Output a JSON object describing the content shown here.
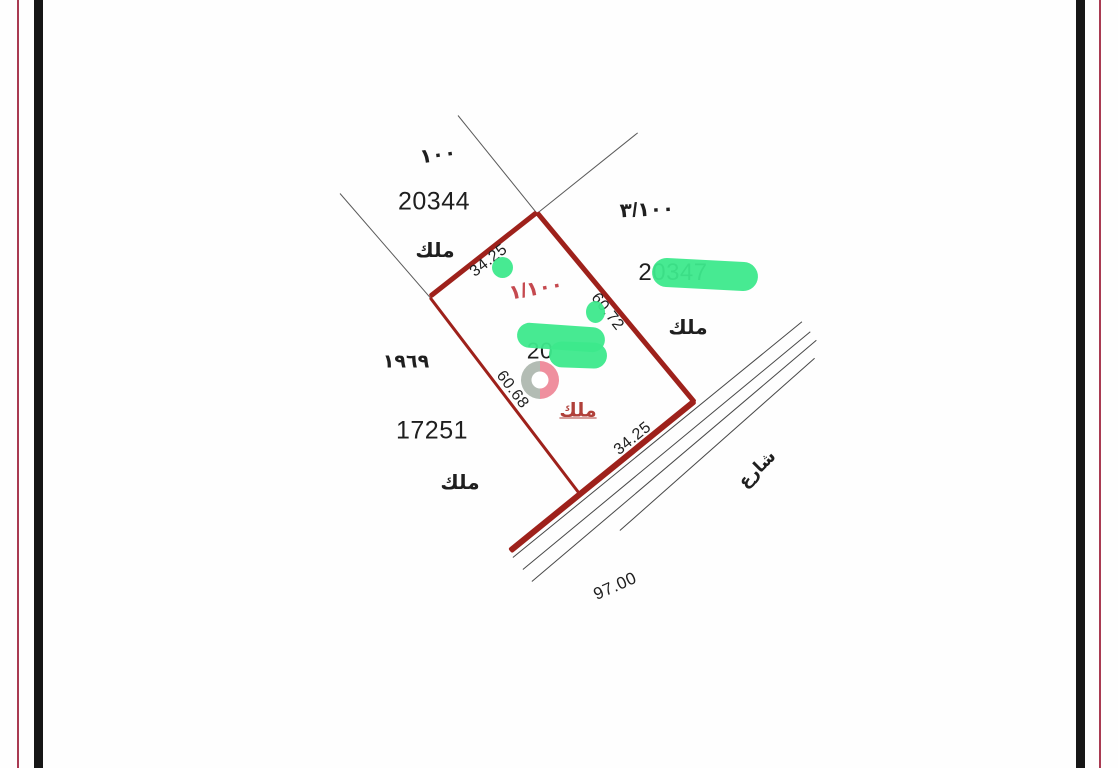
{
  "parcel": {
    "plan_ref": "١/١٠٠",
    "number_visible": "20",
    "tenure": "ملك",
    "dim_top": "34.25",
    "dim_right": "60.72",
    "dim_bottom": "34.25",
    "dim_left": "60.68"
  },
  "neighbors": {
    "north": {
      "ref": "١٠٠",
      "number": "20344",
      "tenure": "ملك"
    },
    "east": {
      "ref": "٣/١٠٠",
      "number": "20347",
      "tenure": "ملك"
    },
    "west": {
      "ref": "١٩٦٩",
      "number": "17251",
      "tenure": "ملك"
    }
  },
  "road": {
    "name": "شارع",
    "frontage": "97.00"
  },
  "colors": {
    "parcel_line": "#9e211b",
    "survey_line": "#5a5a5a",
    "road_line": "#474747",
    "highlight_green": "#3de98c",
    "marker_gray": "#b3bcb4",
    "marker_pink": "#ef8f9e",
    "red_text": "#c5494f",
    "black_text": "#1f1f1f",
    "frame_black": "#161616",
    "frame_red": "#a93a52"
  }
}
